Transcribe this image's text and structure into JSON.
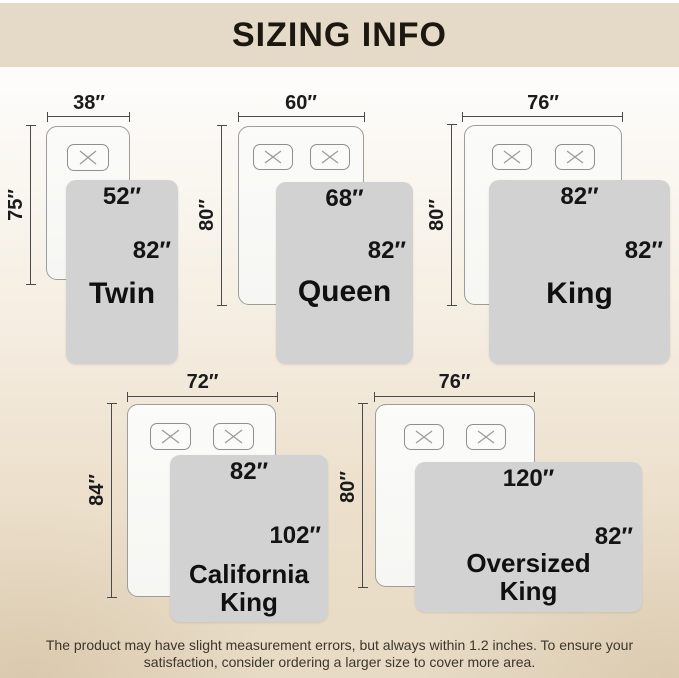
{
  "header": {
    "title": "SIZING INFO"
  },
  "colors": {
    "header_bg": "#e5dac7",
    "background_bottom": "#e7dbc5",
    "blanket_fill": "#d2d2d2",
    "mattress_fill": "#fafaf8",
    "text": "#1b1b1b"
  },
  "sizes": [
    {
      "id": "twin",
      "name": "Twin",
      "mattress_width": "38″",
      "mattress_length": "75″",
      "blanket_width": "52″",
      "blanket_length": "82″",
      "pillow_count": 1
    },
    {
      "id": "queen",
      "name": "Queen",
      "mattress_width": "60″",
      "mattress_length": "80″",
      "blanket_width": "68″",
      "blanket_length": "82″",
      "pillow_count": 2
    },
    {
      "id": "king",
      "name": "King",
      "mattress_width": "76″",
      "mattress_length": "80″",
      "blanket_width": "82″",
      "blanket_length": "82″",
      "pillow_count": 2
    },
    {
      "id": "california-king",
      "name": "California King",
      "mattress_width": "72″",
      "mattress_length": "84″",
      "blanket_width": "82″",
      "blanket_length": "102″",
      "pillow_count": 2
    },
    {
      "id": "oversized-king",
      "name": "Oversized King",
      "mattress_width": "76″",
      "mattress_length": "80″",
      "blanket_width": "120″",
      "blanket_length": "82″",
      "pillow_count": 2
    }
  ],
  "footer": {
    "line1": "The product may have slight measurement errors, but always within 1.2 inches. To ensure your",
    "line2": "satisfaction, consider ordering a larger size to cover more area."
  }
}
